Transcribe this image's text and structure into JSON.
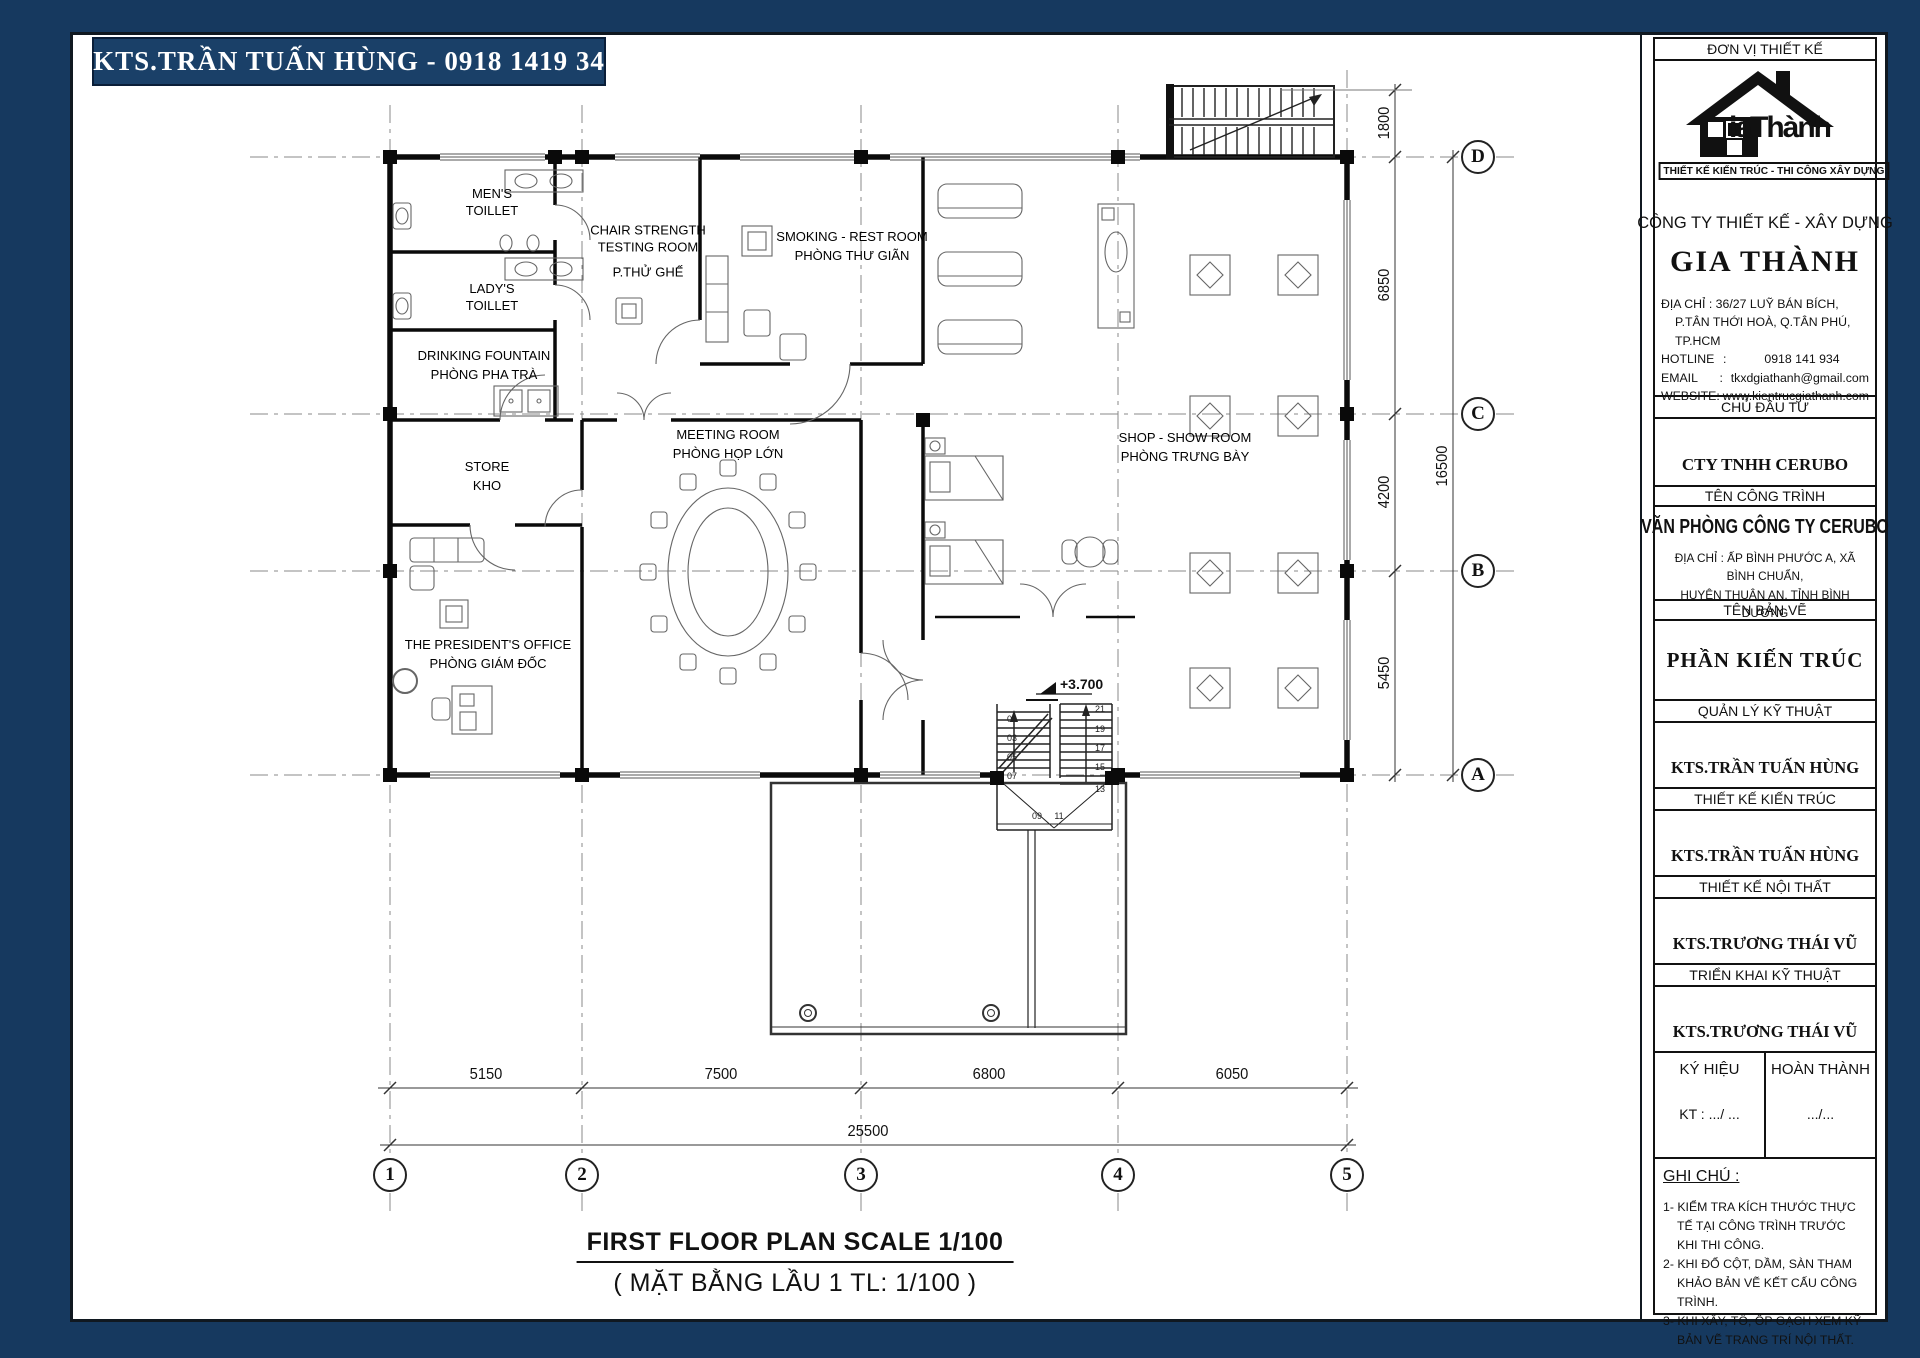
{
  "banner": {
    "text": "KTS.TRẦN TUẤN HÙNG - 0918 1419 34"
  },
  "footer": {
    "title_en": "FIRST FLOOR PLAN  SCALE 1/100",
    "title_vi": "( MẶT BẰNG LẦU 1 TL: 1/100 )"
  },
  "colors": {
    "frame_navy": "#16395F",
    "banner_navy": "#1A4068",
    "line": "#111111"
  },
  "plan": {
    "rooms": {
      "mens": {
        "lines": [
          "MEN'S",
          "TOILLET"
        ]
      },
      "ladys": {
        "lines": [
          "LADY'S",
          "TOILLET"
        ]
      },
      "chair": {
        "lines": [
          "CHAIR STRENGTH",
          "TESTING ROOM"
        ],
        "vi": "P.THỬ GHẾ"
      },
      "smoking": {
        "lines": [
          "SMOKING - REST ROOM"
        ],
        "vi": "PHÒNG THƯ GIÃN"
      },
      "drinking": {
        "lines": [
          "DRINKING FOUNTAIN"
        ],
        "vi": "PHÒNG PHA TRÀ"
      },
      "store": {
        "lines": [
          "STORE"
        ],
        "vi": "KHO"
      },
      "meeting": {
        "lines": [
          "MEETING ROOM"
        ],
        "vi": "PHÒNG HỌP LỚN"
      },
      "president": {
        "lines": [
          "THE PRESIDENT'S OFFICE"
        ],
        "vi": "PHÒNG GIÁM ĐỐC"
      },
      "shop": {
        "lines": [
          "SHOP - SHOW ROOM"
        ],
        "vi": "PHÒNG TRƯNG BÀY"
      }
    },
    "level_marker": "+3.700",
    "grid_cols": [
      "1",
      "2",
      "3",
      "4",
      "5"
    ],
    "grid_rows": [
      "D",
      "C",
      "B",
      "A"
    ],
    "dims_bottom": [
      "5150",
      "7500",
      "6800",
      "6050"
    ],
    "dim_total_bottom": "25500",
    "dims_right": [
      "1800",
      "6850",
      "4200",
      "5450"
    ],
    "dim_total_right": "16500",
    "stair_left": [
      "01",
      "03",
      "05",
      "07"
    ],
    "stair_right": [
      "21",
      "19",
      "17",
      "15",
      "13"
    ],
    "stair_bottom": [
      "09",
      "11"
    ]
  },
  "title_block": {
    "design_unit_label": "ĐƠN VỊ THIẾT KẾ",
    "logo_text": "iaThành",
    "logo_tagline": "THIẾT KẾ KIẾN TRÚC - THI CÔNG XÂY DỰNG",
    "company_type": "CÔNG TY THIẾT KẾ - XÂY DỰNG",
    "company_name": "GIA THÀNH",
    "contact": {
      "address1": "ĐỊA CHỈ : 36/27 LUỸ BÁN BÍCH,",
      "address2": "P.TÂN THỚI HOÀ, Q.TÂN PHÚ, TP.HCM",
      "hotline_label": "HOTLINE",
      "hotline": "0918 141 934",
      "email_label": "EMAIL",
      "email": "tkxdgiathanh@gmail.com",
      "website_label": "WEBSITE",
      "website": "www.kientrucgiathanh.com"
    },
    "investor_label": "CHỦ ĐẦU TƯ",
    "investor": "CTY TNHH CERUBO",
    "project_label": "TÊN CÔNG TRÌNH",
    "project_name": "VĂN PHÒNG CÔNG TY CERUBO",
    "project_address1": "ĐỊA CHỈ : ẤP BÌNH PHƯỚC A, XÃ BÌNH CHUẨN,",
    "project_address2": "HUYỆN THUẬN AN, TỈNH BÌNH DƯƠNG",
    "drawing_label": "TÊN BẢN VẼ",
    "drawing_name": "PHẦN KIẾN TRÚC",
    "sections": [
      {
        "label": "QUẢN LÝ KỸ THUẬT",
        "name": "KTS.TRẦN TUẤN HÙNG"
      },
      {
        "label": "THIẾT KẾ KIẾN TRÚC",
        "name": "KTS.TRẦN TUẤN HÙNG"
      },
      {
        "label": "THIẾT KẾ NỘI THẤT",
        "name": "KTS.TRƯƠNG THÁI VŨ"
      },
      {
        "label": "TRIỂN KHAI KỸ THUẬT",
        "name": "KTS.TRƯƠNG THÁI VŨ"
      }
    ],
    "sign": {
      "symbol_label": "KÝ HIỆU",
      "symbol_value": "KT :  .../ ...",
      "complete_label": "HOÀN THÀNH",
      "complete_value": ".../..."
    },
    "notes_label": "GHI CHÚ :",
    "notes": [
      "1- KIỂM TRA KÍCH THƯỚC THỰC TẾ TẠI CÔNG TRÌNH TRƯỚC KHI THI CÔNG.",
      "2- KHI ĐỔ CỘT, DẦM, SÀN THAM KHẢO BẢN VẼ KẾT CẤU CÔNG TRÌNH.",
      "3- KHI XÂY, TÔ, ỐP GẠCH XEM KỸ BẢN VẼ TRANG TRÍ NỘI THẤT."
    ]
  }
}
